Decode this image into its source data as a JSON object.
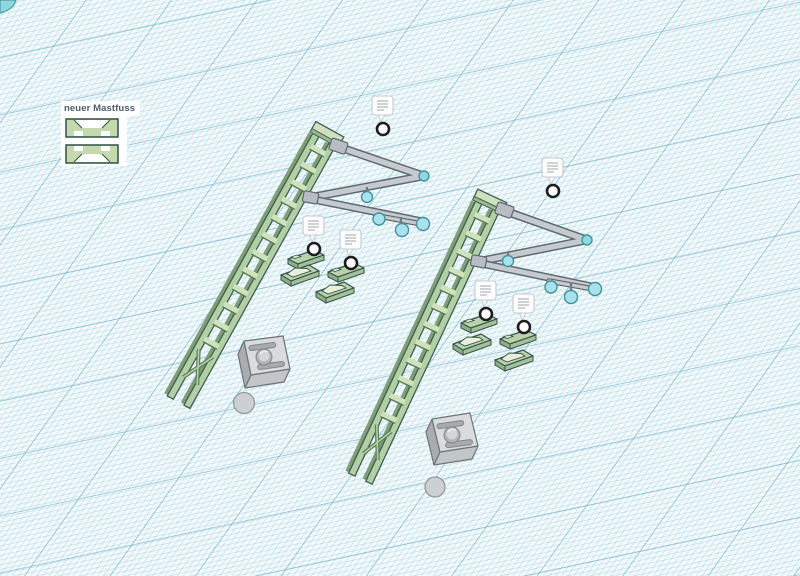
{
  "workspace": {
    "type": "3d-cad-workplane",
    "selection_label": "neuer Mastfuss",
    "visible_note_icons": 6,
    "objects": [
      "catenary-mast-ladder-left",
      "cantilever-arm-left",
      "registration-arm-left",
      "insulator-balls-left",
      "mast-foot-parts-left (4 pieces)",
      "base-cube-left",
      "sphere-left",
      "catenary-mast-ladder-right",
      "cantilever-arm-right",
      "registration-arm-right",
      "insulator-balls-right",
      "mast-foot-parts-right (4 pieces)",
      "base-cube-right",
      "sphere-right",
      "teal-corner-object"
    ]
  },
  "colors": {
    "background": "#f4fafc",
    "grid_fine": "#bfe0ea",
    "grid_major": "#7fb5cb",
    "mast_green": "#b3cfa5",
    "mast_green_light": "#cfe2bb",
    "mast_outline": "#3f5f50",
    "tube_gray": "#c4cacd",
    "tube_outline": "#5d686e",
    "insulator_teal": "#a9e2ec",
    "insulator_outline": "#43929f",
    "base_gray_top": "#d9dbdc",
    "note_ring": "#1d1d1f",
    "label_text": "#4e5d68"
  }
}
